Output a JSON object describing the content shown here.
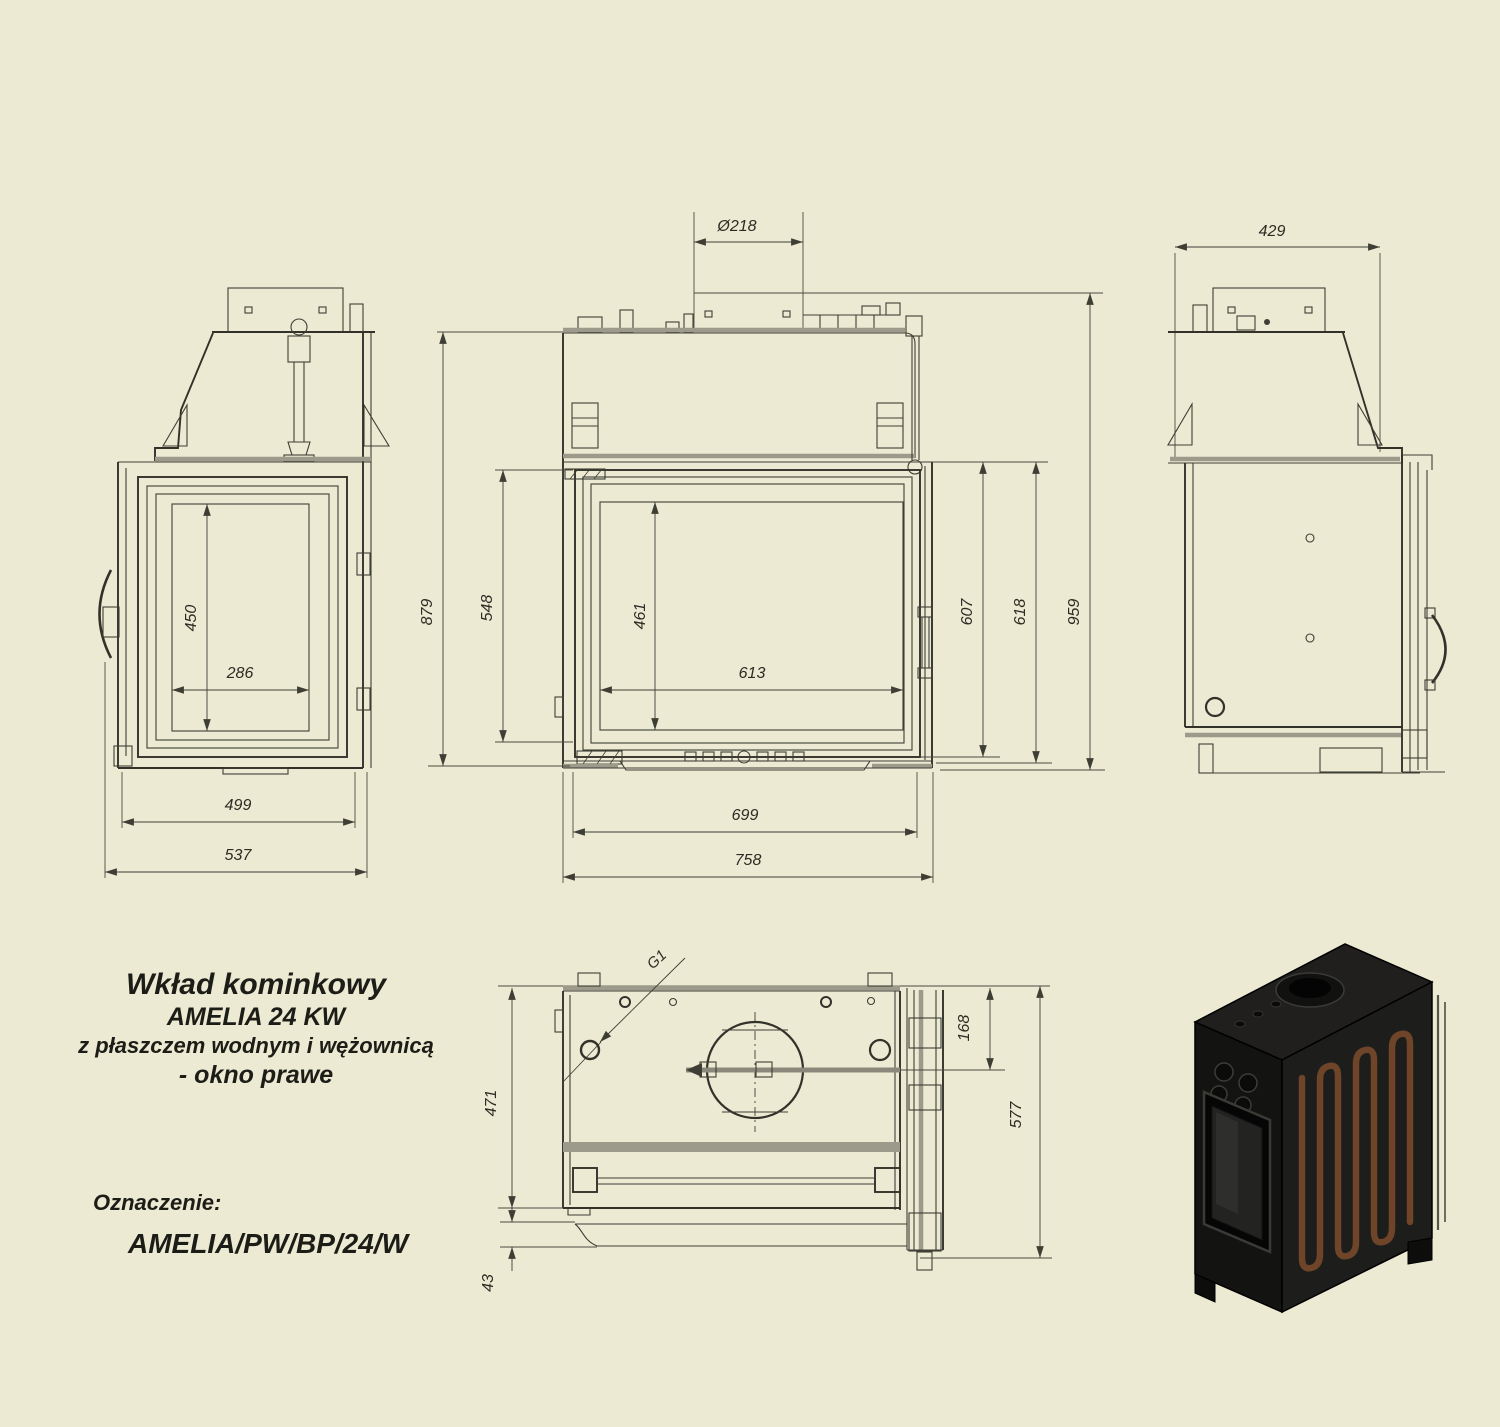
{
  "colors": {
    "background": "#edead3",
    "line": "#3e3e35",
    "thick_line": "#9c9a8a",
    "text": "#1d1d18",
    "coil_copper": "#6e4528",
    "render_body": "#1b1b19"
  },
  "title_block": {
    "line1": "Wkład kominkowy",
    "line2": "AMELIA 24 KW",
    "line3": "z płaszczem wodnym i wężownicą",
    "line4": "- okno prawe",
    "designation_label": "Oznaczenie:",
    "designation_value": "AMELIA/PW/BP/24/W"
  },
  "views": {
    "left_side": {
      "dims": {
        "glass_height": "450",
        "glass_width": "286",
        "body_width": "499",
        "overall_width": "537"
      }
    },
    "front": {
      "dims": {
        "flue_diameter": "Ø218",
        "jacket_height": "879",
        "door_frame_height": "548",
        "glass_height": "461",
        "glass_width": "613",
        "door_height": "607",
        "firebox_height": "618",
        "overall_height": "959",
        "firebox_width": "699",
        "overall_width": "758"
      }
    },
    "right_side": {
      "dims": {
        "overall_depth": "429"
      }
    },
    "top": {
      "dims": {
        "thread_connection": "G1",
        "body_depth": "471",
        "base_lip": "43",
        "flue_axis_offset": "168",
        "overall_depth": "577"
      }
    }
  }
}
